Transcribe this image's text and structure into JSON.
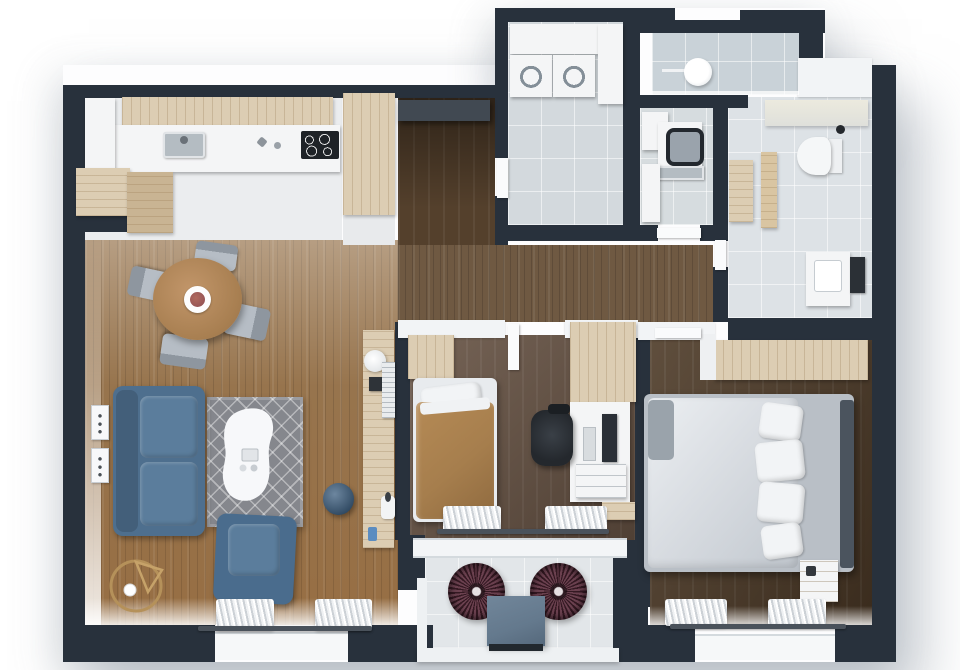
{
  "scene": {
    "type": "3d-rendered-floor-plan",
    "view": "top-down",
    "background": "#ffffff"
  },
  "colors": {
    "wall": "#28313c",
    "wall_top_white": "#f2f4f6",
    "door_white": "#fafbfc",
    "kitchen_floor": "#ebedef",
    "living_floor": "#97744d",
    "corridor_floor": "#6f5942",
    "hallway_floor": "#54402c",
    "bedroom2_floor": "#665243",
    "master_floor": "#4d3a27",
    "tile_laundry": "#d3d9dd",
    "tile_shower": "#c9d2d8",
    "tile_bathroom": "#dde2e6",
    "tile_utility": "#d6dcdf",
    "balcony_floor": "#e2e6e9",
    "wood_cabinet": "#dccdb3",
    "counter_white": "#f4f5f6",
    "cooktop": "#1e2227",
    "sink_steel": "#b4bcc2",
    "sofa": "#4e6f8e",
    "sofa_cushion": "#5b7d9c",
    "armchair": "#4a6c8d",
    "pouf": "#3c5e7f",
    "rug": "#85878d",
    "coffee_table": "#f7f8f9",
    "dining_table": "#b68c5d",
    "chair_gray": "#a9b0b8",
    "duvet_tan": "#a67e4d",
    "duvet_master": "#d9dde2",
    "pillow_white": "#f2f4f6",
    "headboard": "#4b545e",
    "curtain_rod": "#4a525b",
    "balcony_chair": "#5a2b3b",
    "balcony_table": "#64798d",
    "desk_chair": "#24282d",
    "monitor": "#2a2f36",
    "lamp_gold": "#bb975d",
    "radiator_white": "#e9ecee",
    "towel_rail": "#2b3036",
    "toilet": "#f5f7f8",
    "entry_console": "#414952",
    "phone_blue": "#5b8cc0",
    "plate_food": "#8d4d52"
  },
  "rooms": [
    {
      "name": "kitchen",
      "furniture": [
        "upper-cabinets",
        "countertop",
        "sink",
        "cooktop",
        "base-cabinets",
        "tall-cabinet"
      ]
    },
    {
      "name": "living-dining-room",
      "furniture": [
        "round-dining-table",
        "dining-chairs",
        "sofa",
        "armchair",
        "rug",
        "coffee-table",
        "pouf",
        "floor-lamp",
        "wall-frames",
        "console-table",
        "curtains"
      ]
    },
    {
      "name": "entry-hallway",
      "furniture": [
        "entry-console"
      ]
    },
    {
      "name": "laundry-room",
      "furniture": [
        "wall-cabinets",
        "washer",
        "dryer",
        "tall-unit"
      ]
    },
    {
      "name": "utility-wc",
      "furniture": [
        "cabinet",
        "washing-machine",
        "utility-sink"
      ]
    },
    {
      "name": "shower-room",
      "furniture": [
        "rain-shower-head"
      ]
    },
    {
      "name": "bathroom",
      "furniture": [
        "toilet",
        "vanity-sink",
        "towel-rail",
        "bench",
        "shelf"
      ]
    },
    {
      "name": "bedroom-2",
      "furniture": [
        "single-bed",
        "wardrobes",
        "desk",
        "monitor",
        "office-chair",
        "drawer-unit",
        "curtains"
      ]
    },
    {
      "name": "master-bedroom",
      "furniture": [
        "double-bed",
        "pillows",
        "headboard",
        "wardrobe",
        "nightstand",
        "curtains"
      ]
    },
    {
      "name": "balcony",
      "furniture": [
        "wire-lounge-chairs",
        "side-table"
      ]
    }
  ]
}
